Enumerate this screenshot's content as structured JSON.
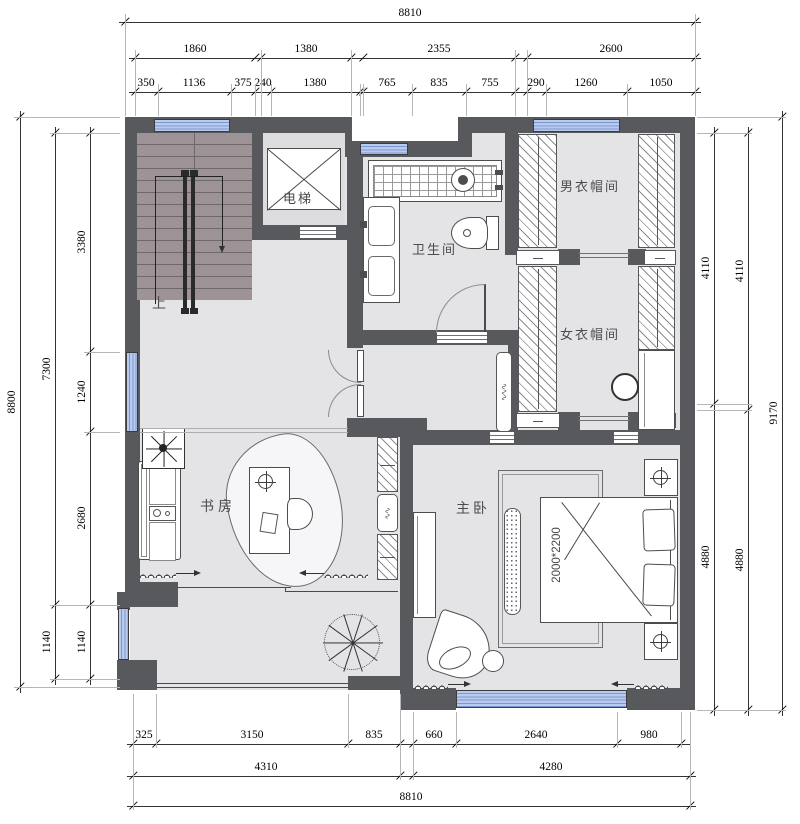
{
  "rooms": {
    "stairs_up": "上",
    "elevator": "电梯",
    "bathroom": "卫生间",
    "mens_cloakroom": "男衣帽间",
    "womens_cloakroom": "女衣帽间",
    "study": "书房",
    "master_bedroom": "主卧",
    "bed_size": "2000*2200"
  },
  "dimensions": {
    "top": {
      "overall": "8810",
      "row_mid": [
        "1860",
        "1380",
        "2355",
        "2600"
      ],
      "row_detail": [
        "350",
        "1136",
        "375",
        "240",
        "1380",
        "765",
        "835",
        "755",
        "290",
        "1260",
        "1050"
      ]
    },
    "bottom": {
      "row_detail": [
        "325",
        "3150",
        "835",
        "660",
        "2640",
        "980"
      ],
      "row_mid": [
        "4310",
        "4280"
      ],
      "overall": "8810"
    },
    "left": {
      "overall": "8800",
      "col_mid": [
        "7300",
        "1140"
      ],
      "col_detail": [
        "3380",
        "1240",
        "2680",
        "1140"
      ]
    },
    "right": {
      "col_inner": [
        "4110",
        "4880"
      ],
      "col_mid": [
        "4110",
        "4880"
      ],
      "overall": "9170"
    }
  },
  "colors": {
    "wall": "#58595c",
    "floor": "#e4e4e6",
    "stair": "#9d9295",
    "window_fill": "#b9cbee",
    "window_line": "#7e97cf"
  }
}
